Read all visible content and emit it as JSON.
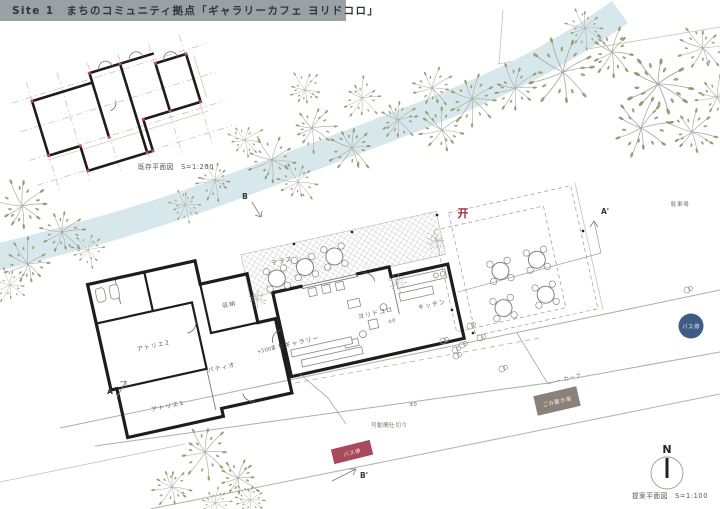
{
  "header": {
    "title": "Site 1　まちのコミュニティ拠点「ギャラリーカフェ ヨリドコロ」"
  },
  "captions": {
    "existing_plan": "既存平面図　S=1:200",
    "proposed_plan": "提案平面図　S=1:100"
  },
  "compass": {
    "north": "N"
  },
  "rooms": {
    "terrace": "テラス",
    "storage": "収納",
    "atelier2": "アトリエ2",
    "atelier1": "アトリエ1",
    "patio": "パティオ",
    "town_gallery": "まちギャラリー",
    "yoridokoro": "ヨリドコロ",
    "kitchen": "キッチン"
  },
  "levels": {
    "patio": "+500",
    "yoridokoro": "±0",
    "road": "±0"
  },
  "annotations": {
    "parking": "駐車場",
    "movable_partition": "可動間仕切り",
    "curve": "カーブ",
    "bus_stop_new": "バス停",
    "bus_stop_existing": "バス停",
    "trash_area": "ごみ置き場",
    "shrine_symbol": "开"
  },
  "section_markers": {
    "a": "A",
    "a_prime": "A'",
    "b": "B",
    "b_prime": "B'"
  },
  "colors": {
    "header_bg": "#9aa1a4",
    "river": "#d7e8ec",
    "tree_leaf": "#8e9261",
    "wall": "#1d1d1d",
    "grid_dot_red": "#c14b52",
    "torii_red": "#9e2b38",
    "bus_stop_red": "#a84a5c",
    "bus_stop_blue": "#3e5c86",
    "trash_gray": "#8b8178"
  }
}
